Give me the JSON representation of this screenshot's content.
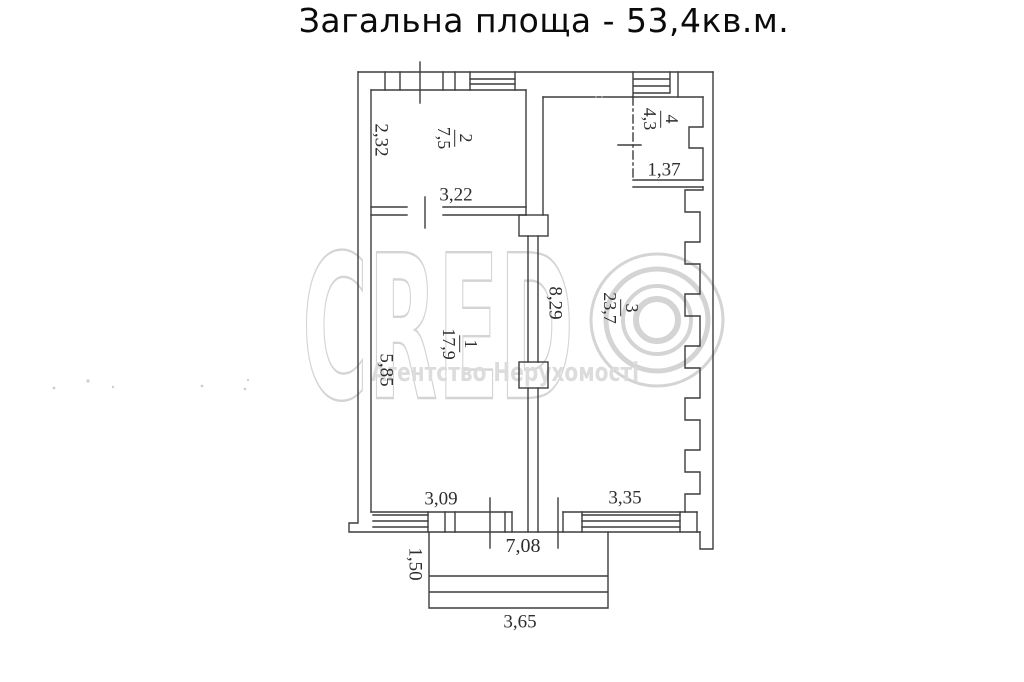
{
  "title": "Загальна площа - 53,4кв.м.",
  "watermark": {
    "brand": "CRED",
    "subtitle": "Агентство Нерухомості",
    "color": "#d4d4d4"
  },
  "plan": {
    "line_color": "#3d3d3d",
    "rooms": [
      {
        "id": "1",
        "area": "17,9",
        "width": "3,09",
        "height": "5,85"
      },
      {
        "id": "2",
        "area": "7,5",
        "width": "3,22",
        "height": "2,32"
      },
      {
        "id": "3",
        "area": "23,7",
        "width": "3,35",
        "height": "8,29"
      },
      {
        "id": "4",
        "area": "4,3",
        "width": "1,37"
      }
    ],
    "bottom_total_width": "7,08",
    "balcony": {
      "depth": "1,50",
      "width": "3,65"
    }
  }
}
